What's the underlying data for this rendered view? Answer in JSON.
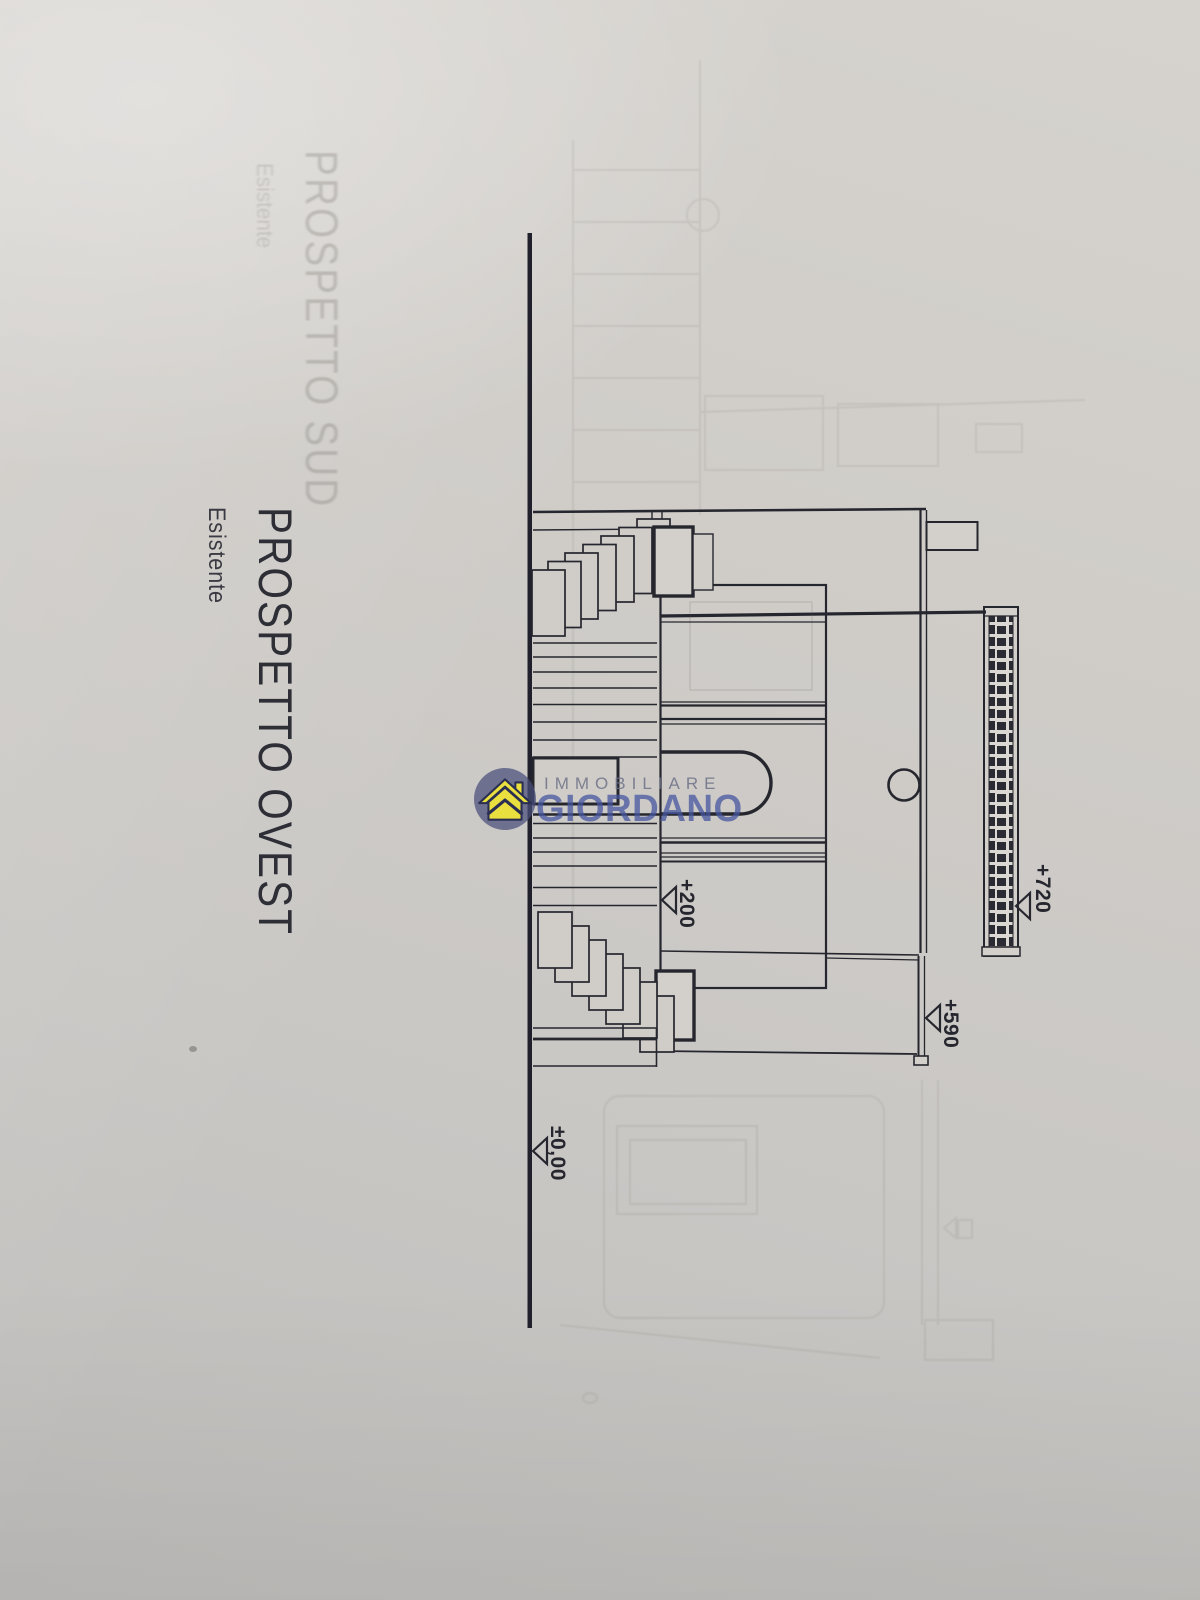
{
  "document": {
    "title": "PROSPETTO OVEST",
    "subtitle": "Esistente",
    "bleedthrough_title": "PROSPETTO SUD",
    "bleedthrough_subtitle": "Esistente"
  },
  "elevation_markers": {
    "roof": "+720",
    "eave": "+590",
    "terrace": "+200",
    "ground": "±0,00"
  },
  "watermark": {
    "brand_top": "IMMOBILIARE",
    "brand_bottom": "GIORDANO",
    "icon": "house-in-circle-icon",
    "colors": {
      "circle": "#484d7a",
      "house": "#e9df3e",
      "text_top": "#6c7187",
      "text_bottom": "#4656a0"
    }
  },
  "drawing": {
    "ink": "#26262e",
    "paper": "#cfccc7"
  }
}
